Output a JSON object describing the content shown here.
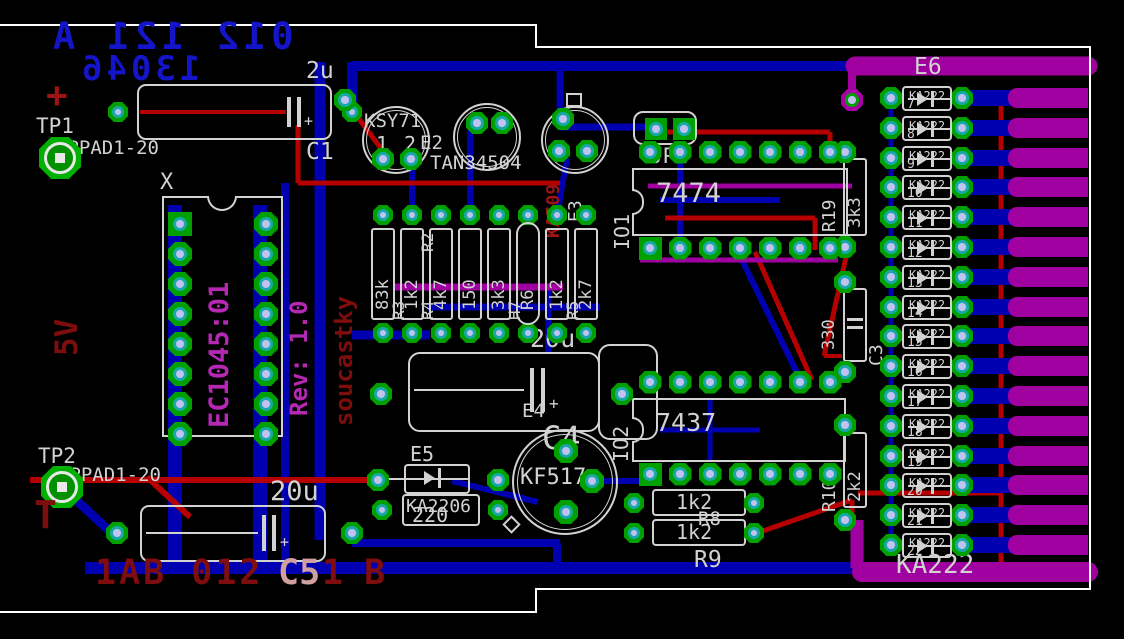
{
  "texts": {
    "doc_line1": "012 121 A",
    "doc_line2": "13046",
    "plus": "+",
    "tp1": "TP1",
    "tp1_pad": "TPPAD1-20",
    "five_v": "5V",
    "c1_value": "2u",
    "c1_ref": "C1",
    "socket_ref": "X",
    "socket_part": "EC1045:01",
    "socket_rev": "Rev: 1.0",
    "soucastky": "soucastky",
    "e1_part": "KSY71",
    "e2_ref": "E2",
    "e2_part": "TAN34504",
    "pins_e1": [
      "1",
      "2"
    ],
    "pins_e2": [
      "2",
      "1"
    ],
    "pins_e3": [
      "1",
      "2",
      "3"
    ],
    "e3_part": "KA509",
    "e3_ref": "E3",
    "jp1": "JP1",
    "io1_ref": "IO1",
    "io1_part": "7474",
    "r19_ref": "R19",
    "r19_value": "3k3",
    "c3_ref": "C3",
    "c3_value": "330",
    "r10_ref": "R10",
    "r10_value": "2k2",
    "io2_ref": "IO2",
    "io2_part": "7437",
    "e4_value": "20u",
    "e4_ref": "E4",
    "c4_ref": "C4",
    "e5_ref": "E5",
    "e5_part": "KA2206",
    "e5_value": "220",
    "q_part": "KF517",
    "r8_value": "1k2",
    "r8_ref": "R8",
    "r9_value": "1k2",
    "r9_ref": "R9",
    "c5_value": "20u",
    "bottom_text_a": "1AB 012",
    "bottom_text_b": "C5",
    "bottom_text_c": "1 B",
    "tp2": "TP2",
    "tp2_pad": "TPPAD1-20",
    "t_label": "T",
    "e6_ref": "E6",
    "diode_part": "KA222",
    "ka222_label": "KA222"
  },
  "resistor_row": [
    {
      "value": "83k",
      "ref": ""
    },
    {
      "value": "1k2",
      "ref": "R3"
    },
    {
      "value": "4k7",
      "ref": "R4",
      "ref2": "R2"
    },
    {
      "value": "150",
      "ref": ""
    },
    {
      "value": "3k3",
      "ref": ""
    },
    {
      "value": "R6",
      "ref": "H7",
      "rounded": true
    },
    {
      "value": "1k2",
      "ref": ""
    },
    {
      "value": "2k7",
      "ref": "R5"
    }
  ],
  "diode_refs": [
    "7",
    "8",
    "9",
    "10",
    "11",
    "12",
    "13",
    "14",
    "15",
    "16",
    "17",
    "18",
    "19",
    "20",
    "21",
    "22"
  ],
  "colors": {
    "bottom_copper": "#0000B0",
    "top_copper": "#B40000",
    "via_layer": "#A000A0",
    "pad_green": "#00A000",
    "pad_ring_cyan": "#18A8A8",
    "silkscreen": "#D2D2D2",
    "doc_blue_text": "#1414C8",
    "magenta_text": "#B428B4",
    "dark_red_text": "#7E0D0D",
    "board_outline": "#FFFFFF"
  }
}
